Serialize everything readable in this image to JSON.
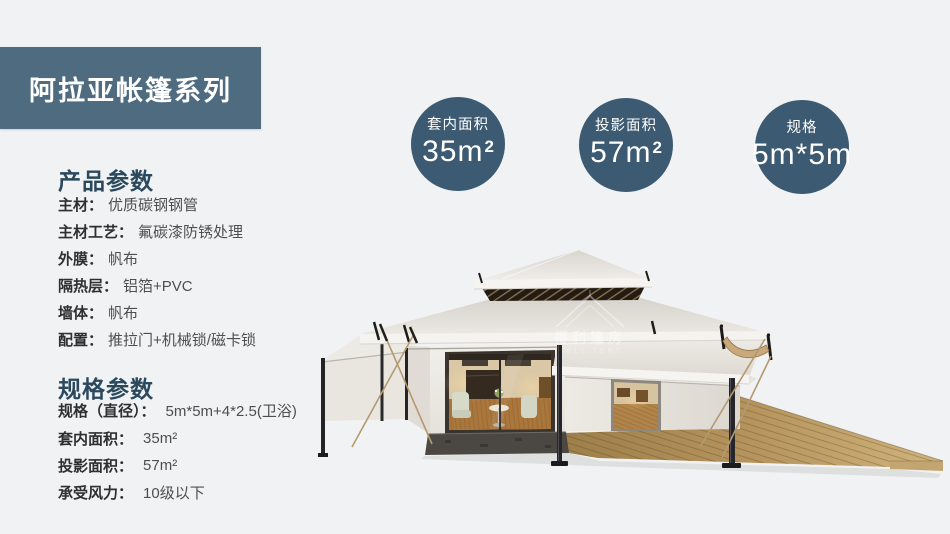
{
  "banner": {
    "title": "阿拉亚帐篷系列",
    "bg_color": "#4e6b80"
  },
  "colors": {
    "page_bg": "#f1f2f3",
    "heading": "#2b495e",
    "badge_bg": "#3c5a71",
    "deck_wood": "#b6945e",
    "canvas": "#e9e6e0"
  },
  "product_params": {
    "heading": "产品参数",
    "rows": [
      {
        "label": "主材：",
        "value": "优质碳钢钢管"
      },
      {
        "label": "主材工艺：",
        "value": "氟碳漆防锈处理"
      },
      {
        "label": "外膜：",
        "value": "帆布"
      },
      {
        "label": "隔热层：",
        "value": "铝箔+PVC"
      },
      {
        "label": "墙体：",
        "value": "帆布"
      },
      {
        "label": "配置：",
        "value": "推拉门+机械锁/磁卡锁"
      }
    ]
  },
  "spec_params": {
    "heading": "规格参数",
    "rows": [
      {
        "label": "规格（直径）：",
        "value": "5m*5m+4*2.5(卫浴)"
      },
      {
        "label": "套内面积：",
        "value": "35m²"
      },
      {
        "label": "投影面积：",
        "value": "57m²"
      },
      {
        "label": "承受风力：",
        "value": "10级以下"
      }
    ]
  },
  "badges": [
    {
      "label": "套内面积",
      "value": "35m",
      "sup": "2"
    },
    {
      "label": "投影面积",
      "value": "57m",
      "sup": "2"
    },
    {
      "label": "规格",
      "value": "5m*5m",
      "sup": ""
    }
  ],
  "watermark": {
    "text": "得利篷房",
    "subtext": "WELL TENT"
  }
}
